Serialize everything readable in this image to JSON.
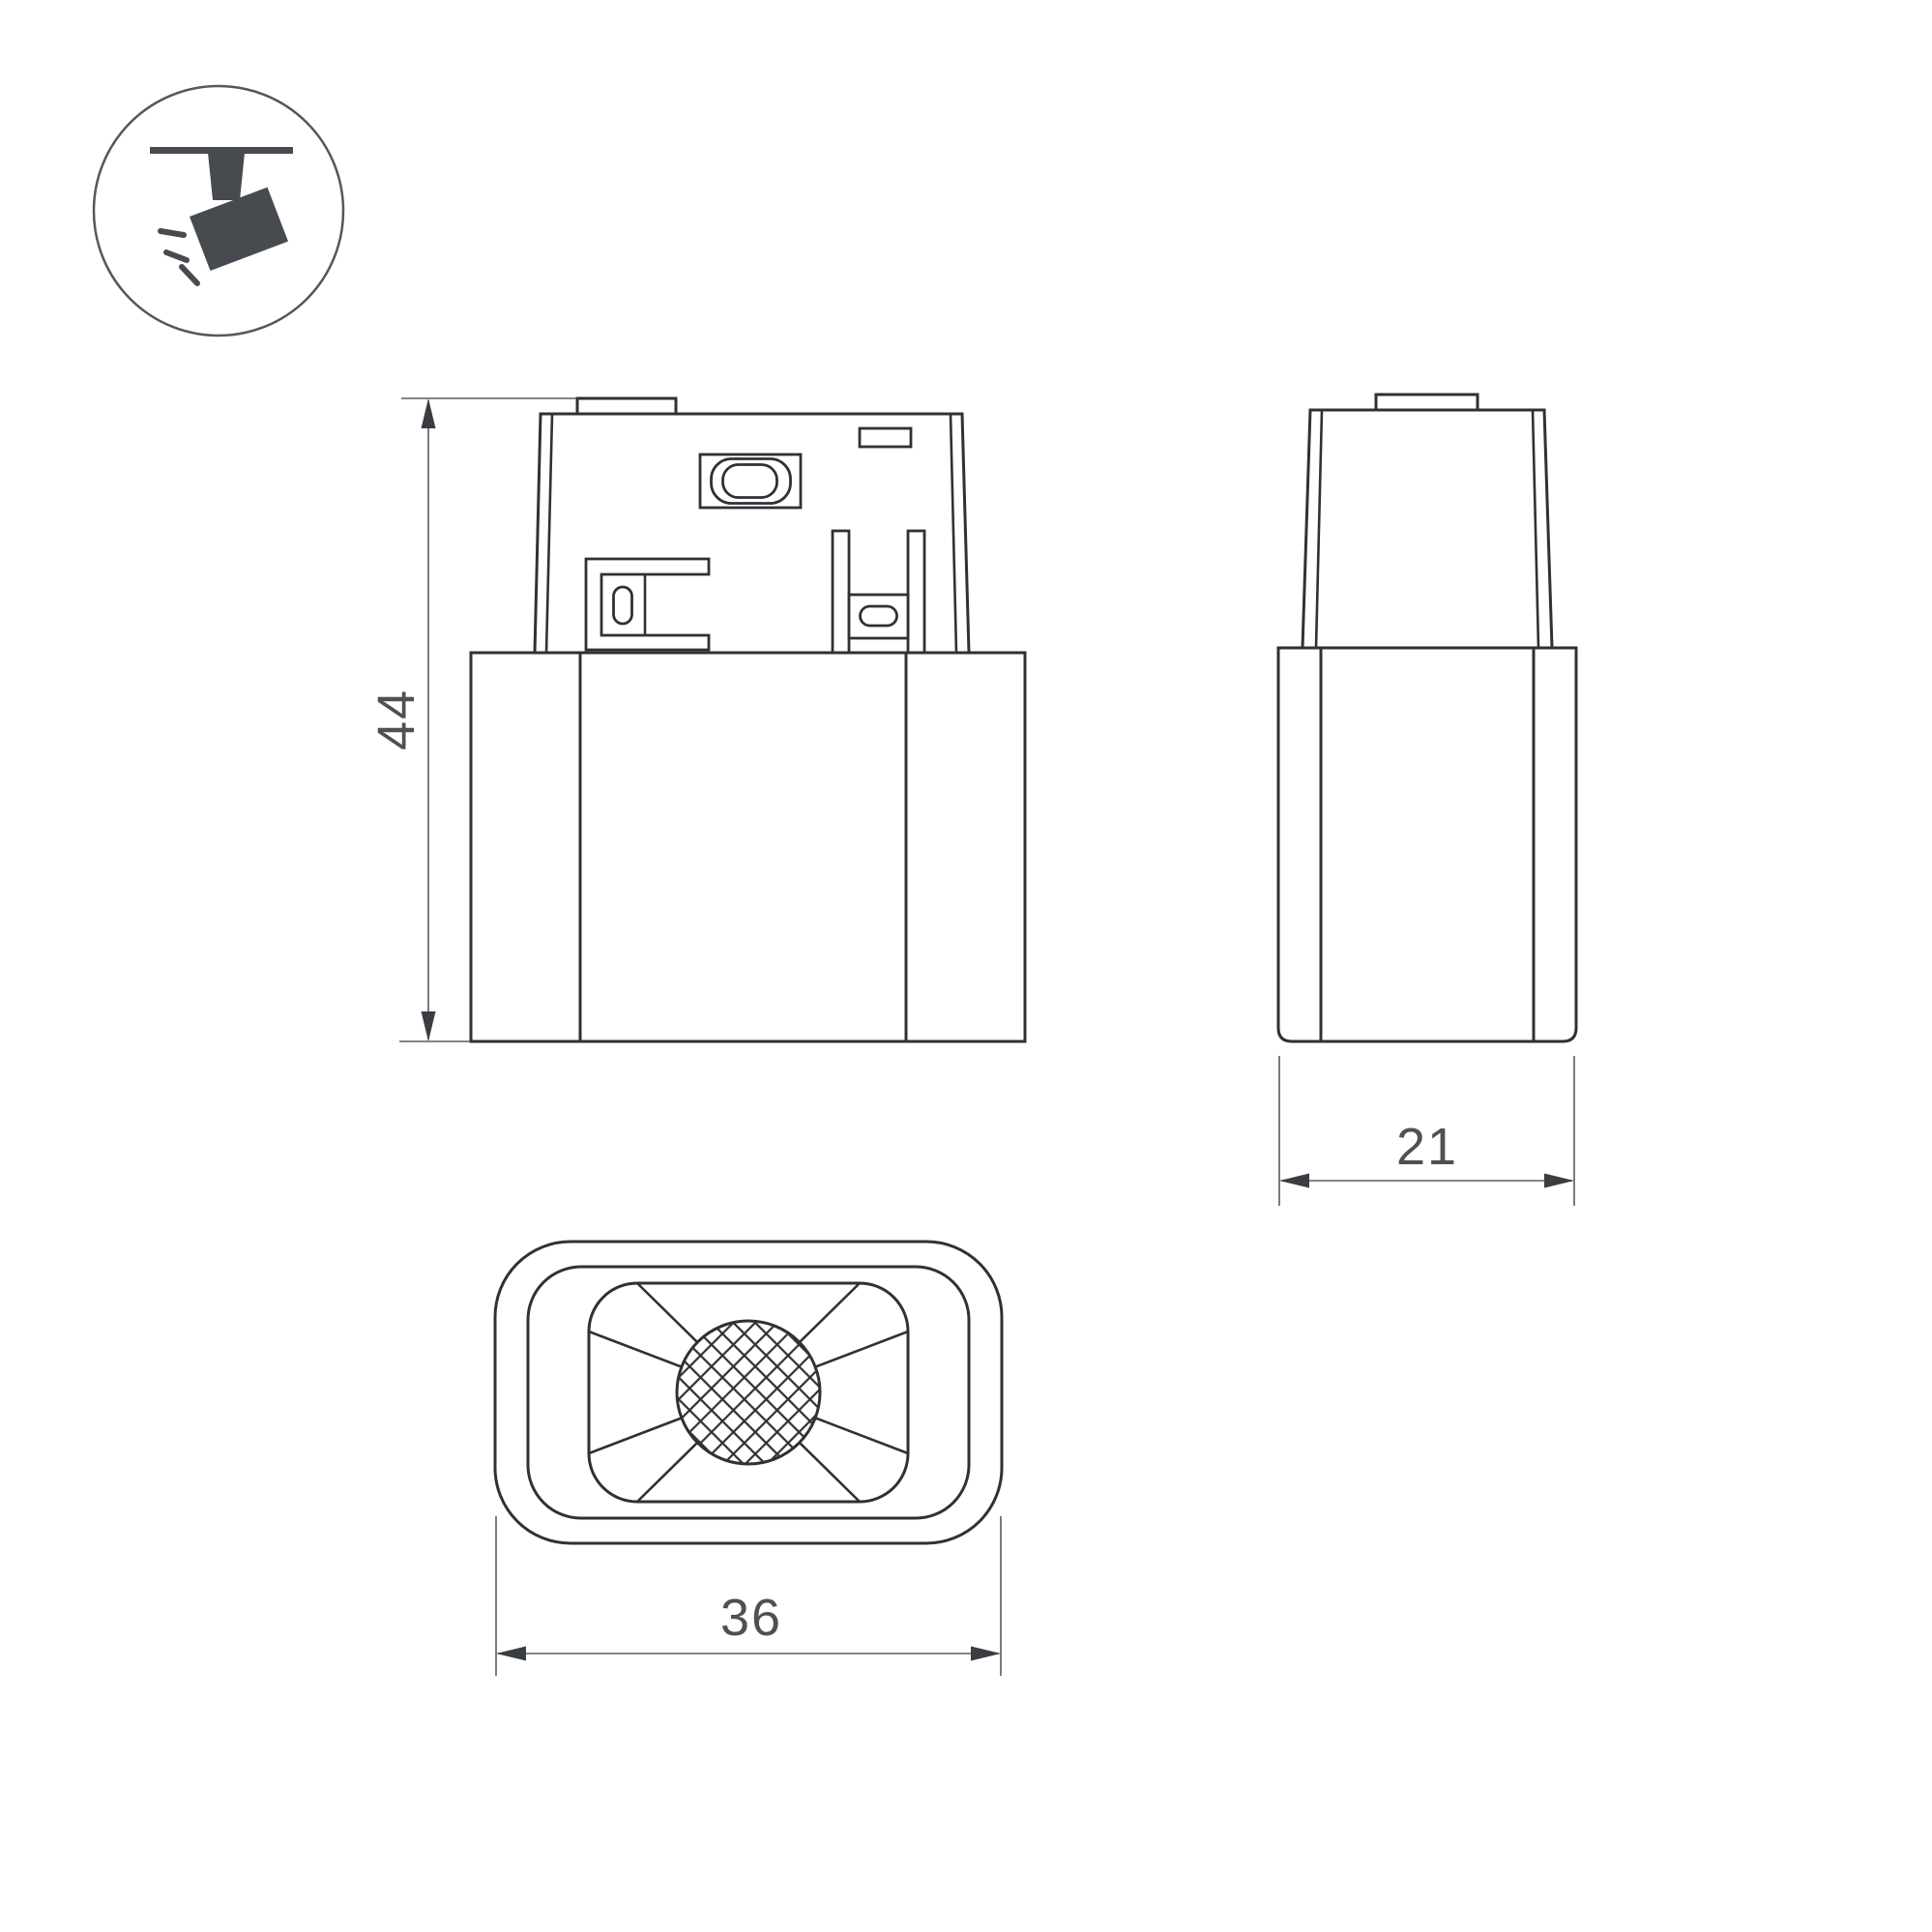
{
  "colors": {
    "background": "#ffffff",
    "outline": "#2e3135",
    "dimension_line": "#595b5e",
    "dimension_text": "#4e5053",
    "icon_fill": "#474b50",
    "icon_ring": "#55575b"
  },
  "icon": {
    "label": "track-spotlight"
  },
  "dimensions": {
    "height": "44",
    "depth": "21",
    "width": "36"
  }
}
